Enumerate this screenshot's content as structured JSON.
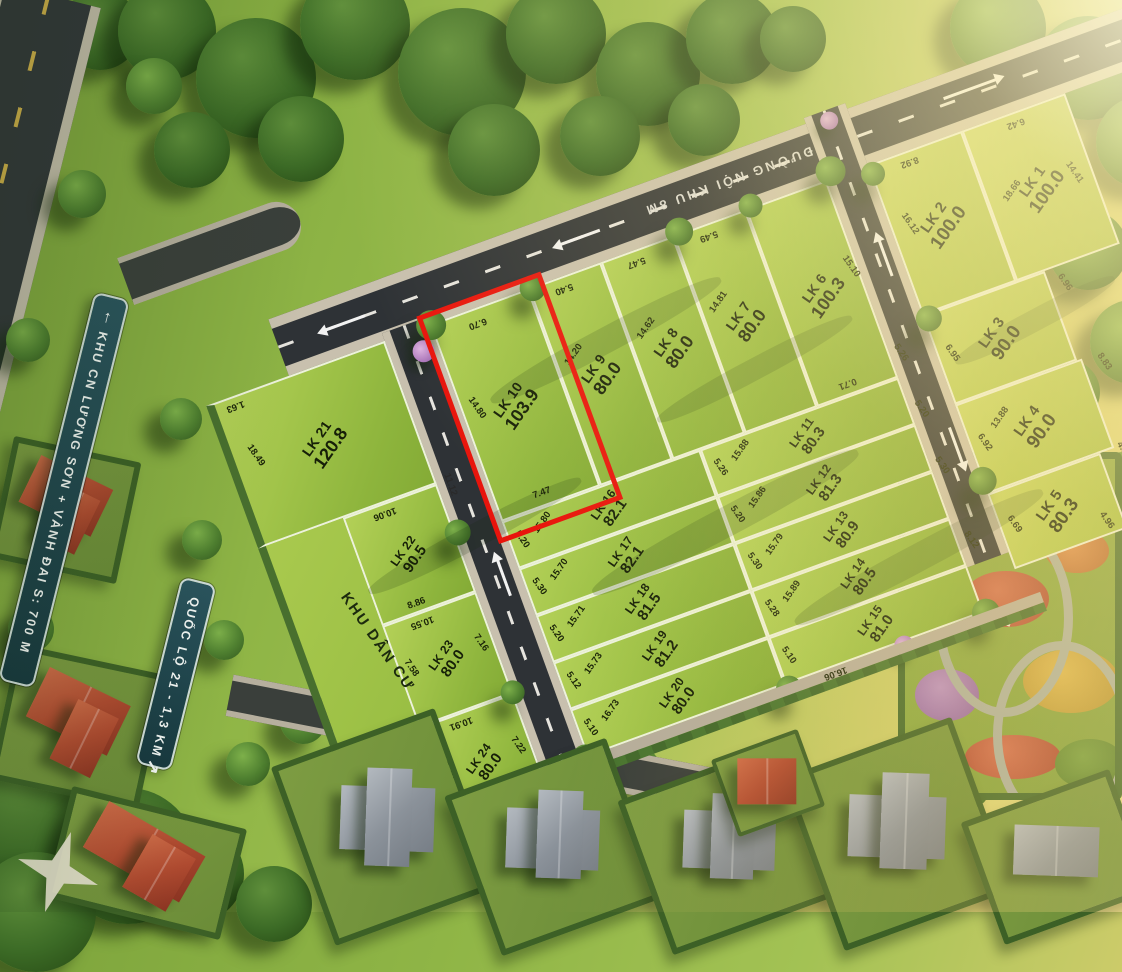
{
  "signs": {
    "sign1": "KHU CN LƯƠNG SƠN + VÀNH ĐAI S: 700 M",
    "sign2": "QUỐC LỘ 21 - 1,3 KM",
    "internal_road": "ĐƯỜNG NỘI KHU 8M",
    "residential_area": "KHU DÂN CƯ",
    "flower_road": "Đường hoa",
    "left_road_dim": "11.12"
  },
  "icons": {
    "arrow_up": "↑",
    "arrow_down_right": "↘"
  },
  "highlight": {
    "plot_id": "LK 10",
    "color": "#e8140c"
  },
  "plots": [
    {
      "id": "LK 1",
      "area": "100.0",
      "dims": [
        "18.66",
        "14.41",
        "6.42"
      ]
    },
    {
      "id": "LK 2",
      "area": "100.0",
      "dims": [
        "16.12",
        "8.92"
      ]
    },
    {
      "id": "LK 3",
      "area": "90.0",
      "dims": [
        "6.95"
      ]
    },
    {
      "id": "LK 4",
      "area": "90.0",
      "dims": [
        "13.88",
        "6.92"
      ]
    },
    {
      "id": "LK 5",
      "area": "80.3",
      "dims": [
        "6.69"
      ]
    },
    {
      "id": "LK 6",
      "area": "100.3",
      "dims": [
        "15.10",
        "0.71"
      ]
    },
    {
      "id": "LK 7",
      "area": "80.0",
      "dims": [
        "14.81",
        "5.49"
      ]
    },
    {
      "id": "LK 8",
      "area": "80.0",
      "dims": [
        "14.62",
        "5.47"
      ]
    },
    {
      "id": "LK 9",
      "area": "80.0",
      "dims": [
        "14.20",
        "5.40"
      ]
    },
    {
      "id": "LK 10",
      "area": "103.9",
      "dims": [
        "6.70",
        "14.80",
        "7.47"
      ]
    },
    {
      "id": "LK 11",
      "area": "80.3",
      "dims": [
        "15.88",
        "5.26"
      ]
    },
    {
      "id": "LK 12",
      "area": "81.3",
      "dims": [
        "15.86",
        "5.20"
      ]
    },
    {
      "id": "LK 13",
      "area": "80.9",
      "dims": [
        "15.79",
        "5.30"
      ]
    },
    {
      "id": "LK 14",
      "area": "80.5",
      "dims": [
        "15.89",
        "5.28"
      ]
    },
    {
      "id": "LK 15",
      "area": "81.0",
      "dims": [
        "5.10"
      ]
    },
    {
      "id": "LK 16",
      "area": "82.1",
      "dims": [
        "15.80",
        "5.20"
      ]
    },
    {
      "id": "LK 17",
      "area": "82.1",
      "dims": [
        "15.70",
        "5.30"
      ]
    },
    {
      "id": "LK 18",
      "area": "81.5",
      "dims": [
        "15.71",
        "5.20"
      ]
    },
    {
      "id": "LK 19",
      "area": "81.2",
      "dims": [
        "15.73",
        "5.12"
      ]
    },
    {
      "id": "LK 20",
      "area": "80.0",
      "dims": [
        "16.73",
        "5.10"
      ]
    },
    {
      "id": "LK 21",
      "area": "120.8",
      "dims": [
        "18.49",
        "1.63"
      ]
    },
    {
      "id": "LK 22",
      "area": "90.5",
      "dims": [
        "10.06",
        "8.86"
      ]
    },
    {
      "id": "LK 23",
      "area": "80.0",
      "dims": [
        "10.55",
        "7.58",
        "7.16"
      ]
    },
    {
      "id": "LK 24",
      "area": "80.0",
      "dims": [
        "10.91",
        "7.26",
        "11.30",
        "7.22"
      ]
    }
  ],
  "boundary_dims": [
    "6.96",
    "8.83",
    "4.18",
    "4.96",
    "16.06",
    "8.12",
    "5.26",
    "5.20",
    "5.30"
  ]
}
